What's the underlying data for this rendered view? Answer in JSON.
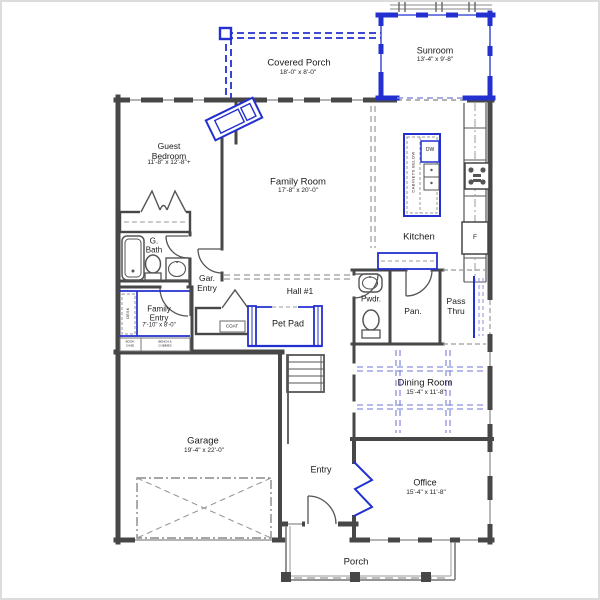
{
  "plan": {
    "rooms": {
      "sunroom": {
        "label": "Sunroom",
        "dims": "13'-4\" x 9'-8\""
      },
      "covered_porch": {
        "label": "Covered Porch",
        "dims": "18'-0\" x 8'-0\""
      },
      "guest_bedroom": {
        "label": "Guest\nBedroom",
        "dims": "11'-8\" x 12'-8\"+"
      },
      "family_room": {
        "label": "Family Room",
        "dims": "17'-8\" x 20'-0\""
      },
      "kitchen": {
        "label": "Kitchen"
      },
      "guest_bath": {
        "label": "G.\nBath"
      },
      "garage_entry": {
        "label": "Gar.\nEntry"
      },
      "hall_1": {
        "label": "Hall #1"
      },
      "family_entry": {
        "label": "Family\nEntry",
        "dims": "7'-10\" x 8'-0\""
      },
      "powder": {
        "label": "Pwdr."
      },
      "pantry": {
        "label": "Pan."
      },
      "pass_thru": {
        "label": "Pass\nThru"
      },
      "coat": {
        "label": "COAT"
      },
      "pet_pad": {
        "label": "Pet Pad"
      },
      "dining_room": {
        "label": "Dining Room",
        "dims": "15'-4\" x 11'-8\""
      },
      "garage": {
        "label": "Garage",
        "dims": "19'-4\" x 22'-0\""
      },
      "entry": {
        "label": "Entry"
      },
      "office": {
        "label": "Office",
        "dims": "15'-4\" x 11'-8\""
      },
      "porch": {
        "label": "Porch"
      }
    },
    "fixtures": {
      "dishwasher": "DW",
      "refrigerator": "F",
      "cabinets_below": "CABINETS BELOW",
      "desk": "DESK",
      "book_case": "BOOK\nCASE",
      "bench_cubbies": "BENCH &\nCUBBIES"
    },
    "colors": {
      "wall": "#474747",
      "accent_blue": "#2330cf",
      "ceiling_dash_blue": "#8a92dc",
      "dashed_gray": "#999999"
    }
  }
}
